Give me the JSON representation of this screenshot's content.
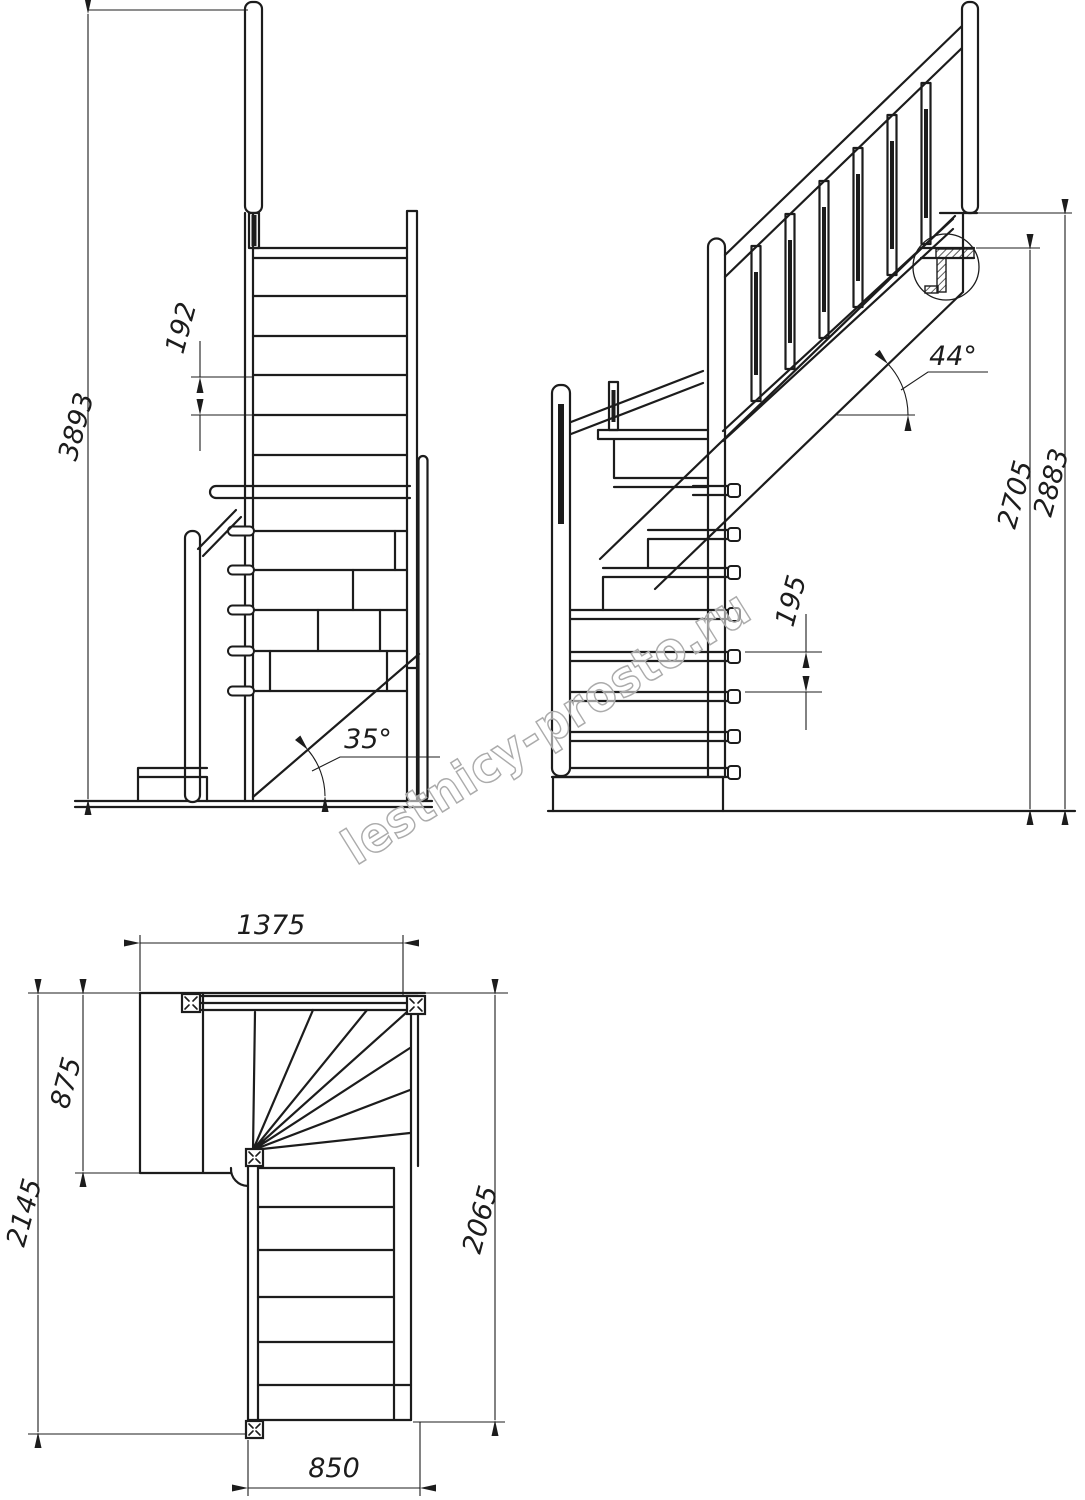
{
  "watermark": {
    "text": "lestnicy-prosto.ru"
  },
  "views": {
    "front": {
      "dims": {
        "total_height": "3893",
        "riser": "192",
        "stair_angle": "35°"
      }
    },
    "side": {
      "dims": {
        "stair_angle": "44°",
        "riser": "195",
        "height_to_tread": "2705",
        "height_to_floor": "2883"
      }
    },
    "plan": {
      "dims": {
        "upper_flight_width": "1375",
        "landing_depth": "875",
        "total_depth": "2145",
        "lower_flight_length": "2065",
        "lower_flight_width": "850"
      }
    }
  }
}
